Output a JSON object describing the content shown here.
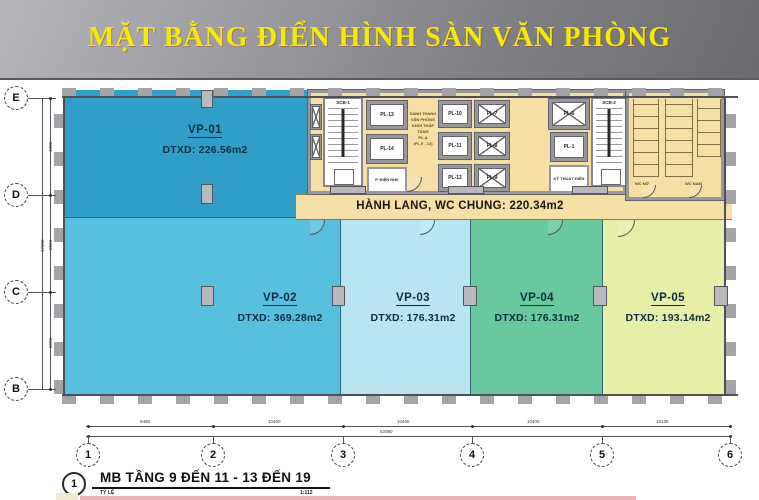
{
  "header": {
    "title": "MẶT BẰNG ĐIỂN HÌNH SÀN VĂN PHÒNG"
  },
  "zones": [
    {
      "label": "VP-01",
      "area": "DTXD: 226.56m2"
    },
    {
      "label": "VP-02",
      "area": "DTXD: 369.28m2"
    },
    {
      "label": "VP-03",
      "area": "DTXD: 176.31m2"
    },
    {
      "label": "VP-04",
      "area": "DTXD: 176.31m2"
    },
    {
      "label": "VP-05",
      "area": "DTXD: 193.14m2"
    }
  ],
  "corridor": {
    "label": "HÀNH LANG, WC CHUNG: 220.34m2"
  },
  "core": {
    "stairs": [
      "SCB-1",
      "SCB-2"
    ],
    "lifts": [
      "PL-13",
      "PL-14",
      "PL-10",
      "PL-11",
      "PL-12",
      "PL-7",
      "PL-8",
      "PL-9",
      "PL-6",
      "PL-1"
    ],
    "room_electrical": "P. ĐIỆN NHẸ",
    "room_technical": "KỸ THUẬT ĐIỆN",
    "lobby_lines": [
      "SẢNH THANG",
      "VĂN PHÒNG",
      "KHỐI THẤP TẦNG",
      "PL-A",
      "(PL.9 - 13)"
    ],
    "wc_female": "WC NỮ",
    "wc_male": "WC NAM"
  },
  "grid": {
    "rows": [
      "E",
      "D",
      "C",
      "B"
    ],
    "cols": [
      "1",
      "2",
      "3",
      "4",
      "5",
      "6"
    ]
  },
  "dimensions": {
    "bottom_segments": [
      "9480",
      "10400",
      "10400",
      "10400",
      "10136"
    ],
    "bottom_total": "52080",
    "left_segments": [
      "4200",
      "6550",
      "6550"
    ],
    "left_total": "17300"
  },
  "titleblock": {
    "number": "1",
    "title": "MB TẦNG 9 ĐẾN 11 - 13 ĐẾN 19",
    "scale_label": "TỶ LỆ",
    "scale_value": "1:112"
  },
  "colors": {
    "vp01": "#2f9fca",
    "vp02": "#58c0df",
    "vp03": "#b9e5f2",
    "vp04": "#68c89e",
    "vp05": "#e7eea8",
    "service": "#f6dfa4"
  }
}
